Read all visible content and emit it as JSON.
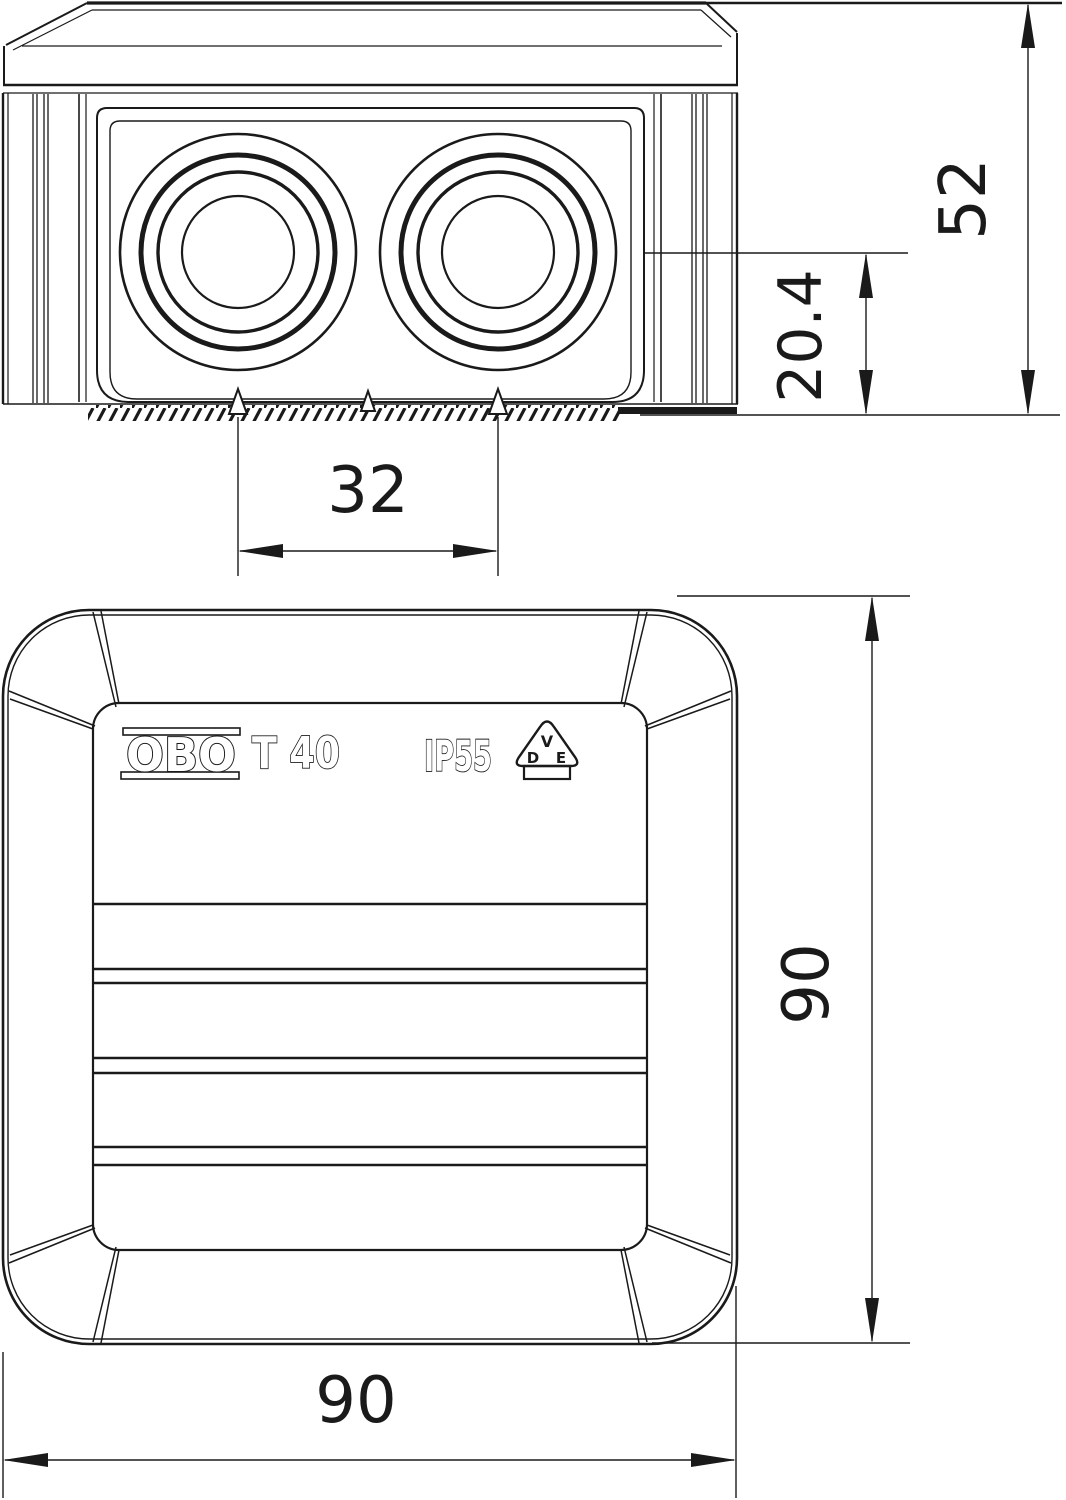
{
  "page": {
    "title": "OBO T 40 junction box dimensional drawing",
    "background": "#ffffff",
    "line_color": "#1a1a1a"
  },
  "markings": {
    "brand": "OBO",
    "model": "T 40",
    "ip_rating": "IP55",
    "vde_mark": {
      "v": "V",
      "d": "D",
      "e": "E"
    }
  },
  "dimensions": {
    "side_view": {
      "total_height": "52",
      "entry_center_height": "20.4",
      "entry_spacing": "32"
    },
    "plan_view": {
      "width": "90",
      "height": "90"
    }
  }
}
